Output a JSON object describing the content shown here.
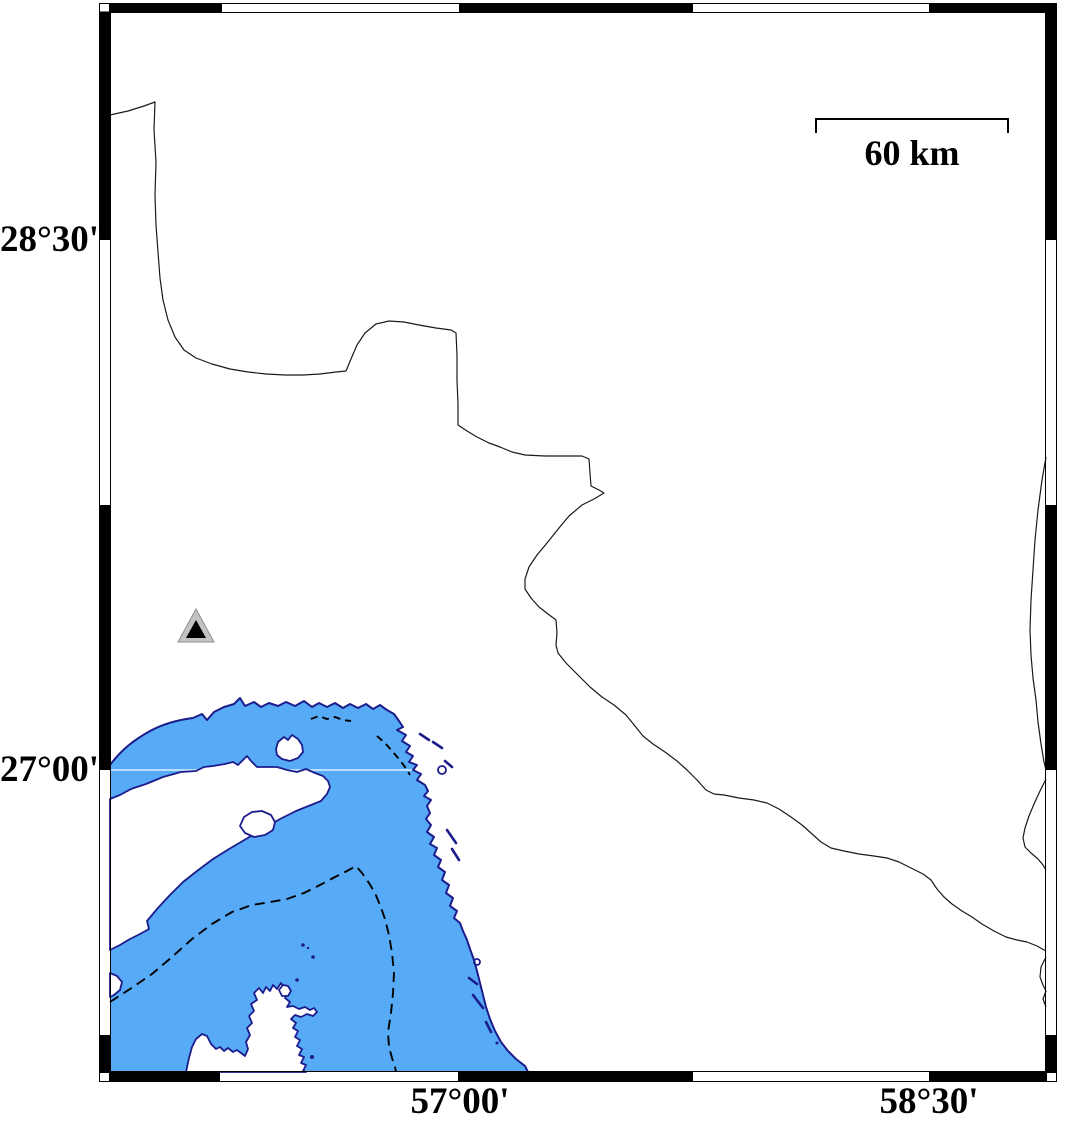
{
  "axes": {
    "left": [
      "28°30'",
      "27°00'"
    ],
    "bottom": [
      "57°00'",
      "58°30'"
    ]
  },
  "scale_bar": {
    "label": "60 km"
  },
  "map_symbols": {
    "triangle_marker": "filled triangle station/volcano symbol"
  },
  "colors": {
    "background": "#ffffff",
    "sea": "#57aaf5",
    "coastline": "#1c1c8c",
    "contour": "#000000",
    "border": "#1a1a1a",
    "gridline": "#ffffff",
    "frame": "#000000",
    "marker_fill": "#c3c3c3",
    "marker_edge": "#8f8f8f",
    "marker_core": "#000000"
  }
}
